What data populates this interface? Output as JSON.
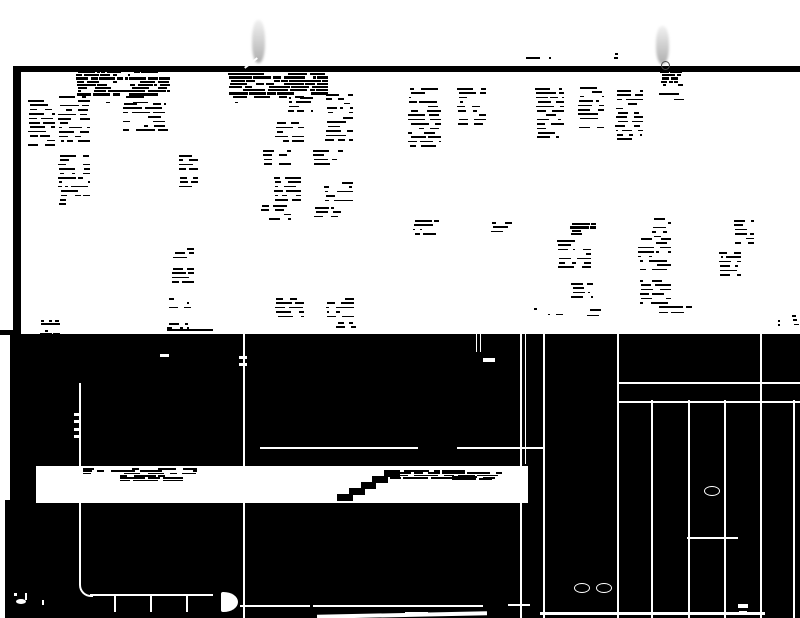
{
  "document": {
    "type": "degraded-binary-scan",
    "legible_text": ""
  },
  "colors": {
    "paper": "#ffffff",
    "ink": "#000000",
    "pin_gray": "#bfbfbf",
    "pin_ring": "#4a4a4a",
    "map_line": "#ffffff"
  },
  "paper": {
    "left_strip": [
      0,
      0,
      13,
      618
    ],
    "top_bar": [
      13,
      66,
      787,
      6
    ],
    "left_border": [
      13,
      66,
      8,
      269
    ],
    "page_edge_mark": [
      0,
      330,
      18,
      5
    ]
  },
  "pins": [
    {
      "body": [
        252,
        20,
        13,
        43
      ],
      "ring": null
    },
    {
      "body": [
        656,
        26,
        13,
        38
      ],
      "ring": [
        661,
        61,
        7,
        7
      ]
    }
  ],
  "text_blobs": [
    [
      76,
      71,
      94,
      25,
      "dense"
    ],
    [
      84,
      96,
      82,
      8,
      "sparse"
    ],
    [
      228,
      70,
      100,
      26,
      "dense"
    ],
    [
      232,
      96,
      72,
      7,
      "sparse"
    ],
    [
      28,
      100,
      27,
      45,
      "text"
    ],
    [
      58,
      96,
      32,
      46,
      "text"
    ],
    [
      123,
      103,
      45,
      29,
      "text"
    ],
    [
      58,
      155,
      32,
      50,
      "text"
    ],
    [
      178,
      155,
      20,
      33,
      "text"
    ],
    [
      287,
      97,
      26,
      17,
      "text"
    ],
    [
      325,
      94,
      28,
      22,
      "text"
    ],
    [
      275,
      118,
      29,
      26,
      "text"
    ],
    [
      325,
      117,
      28,
      27,
      "text"
    ],
    [
      263,
      150,
      28,
      18,
      "text"
    ],
    [
      313,
      150,
      30,
      18,
      "text"
    ],
    [
      273,
      177,
      28,
      24,
      "text"
    ],
    [
      323,
      182,
      30,
      19,
      "text"
    ],
    [
      260,
      205,
      31,
      16,
      "text"
    ],
    [
      313,
      207,
      28,
      14,
      "text"
    ],
    [
      275,
      298,
      29,
      19,
      "text"
    ],
    [
      325,
      298,
      29,
      19,
      "text"
    ],
    [
      408,
      88,
      33,
      61,
      "text"
    ],
    [
      457,
      88,
      29,
      38,
      "text"
    ],
    [
      535,
      88,
      29,
      50,
      "text"
    ],
    [
      578,
      87,
      26,
      41,
      "text"
    ],
    [
      615,
      90,
      28,
      53,
      "text"
    ],
    [
      658,
      93,
      26,
      10,
      "sparse"
    ],
    [
      660,
      71,
      23,
      17,
      "dense"
    ],
    [
      570,
      220,
      26,
      14,
      "dense"
    ],
    [
      557,
      240,
      34,
      31,
      "text"
    ],
    [
      570,
      283,
      23,
      18,
      "text"
    ],
    [
      652,
      218,
      19,
      20,
      "text"
    ],
    [
      638,
      238,
      33,
      36,
      "text"
    ],
    [
      638,
      280,
      33,
      28,
      "text"
    ],
    [
      733,
      220,
      21,
      24,
      "text"
    ],
    [
      718,
      252,
      23,
      24,
      "text"
    ],
    [
      413,
      220,
      26,
      18,
      "text"
    ],
    [
      490,
      222,
      22,
      14,
      "text"
    ],
    [
      172,
      248,
      22,
      10,
      "text"
    ],
    [
      170,
      268,
      24,
      18,
      "text"
    ],
    [
      168,
      298,
      23,
      10,
      "text"
    ],
    [
      167,
      323,
      22,
      8,
      "text"
    ],
    [
      167,
      329,
      46,
      2,
      "solid"
    ],
    [
      533,
      308,
      30,
      9,
      "sparse"
    ],
    [
      573,
      309,
      28,
      8,
      "sparse"
    ],
    [
      640,
      306,
      52,
      11,
      "sparse"
    ],
    [
      335,
      322,
      26,
      9,
      "text"
    ],
    [
      40,
      320,
      20,
      15,
      "dense"
    ],
    [
      775,
      320,
      10,
      8,
      "text"
    ],
    [
      525,
      57,
      26,
      6,
      "sparse"
    ],
    [
      612,
      53,
      6,
      9,
      "text"
    ],
    [
      792,
      315,
      8,
      14,
      "text"
    ]
  ],
  "map": {
    "region": [
      10,
      334,
      790,
      284
    ],
    "strip_taper": [
      5,
      500,
      5,
      118
    ],
    "lines": [
      [
        79,
        383,
        2,
        201
      ],
      [
        243,
        334,
        2,
        284
      ],
      [
        520,
        334,
        2,
        284
      ],
      [
        525,
        334,
        1,
        130
      ],
      [
        543,
        334,
        2,
        284
      ],
      [
        617,
        334,
        2,
        284
      ],
      [
        651,
        400,
        2,
        218
      ],
      [
        688,
        400,
        2,
        218
      ],
      [
        724,
        400,
        2,
        218
      ],
      [
        760,
        334,
        2,
        284
      ],
      [
        793,
        400,
        2,
        218
      ],
      [
        476,
        334,
        1,
        18
      ],
      [
        480,
        334,
        1,
        18
      ],
      [
        617,
        382,
        183,
        2
      ],
      [
        617,
        401,
        183,
        2
      ],
      [
        260,
        447,
        158,
        2
      ],
      [
        457,
        447,
        86,
        2
      ],
      [
        687,
        537,
        51,
        2
      ],
      [
        90,
        594,
        123,
        2
      ],
      [
        114,
        594,
        2,
        18
      ],
      [
        150,
        594,
        2,
        18
      ],
      [
        186,
        594,
        2,
        18
      ],
      [
        240,
        605,
        70,
        2
      ],
      [
        313,
        605,
        170,
        2
      ],
      [
        405,
        612,
        23,
        2
      ],
      [
        508,
        604,
        22,
        2
      ]
    ],
    "arc": [
      79,
      583,
      12,
      12
    ],
    "disc": [
      221,
      592,
      17,
      20
    ],
    "wedges": [
      [
        317,
        613,
        170,
        4,
        -1.2
      ],
      [
        540,
        612,
        225,
        3,
        0
      ]
    ],
    "ellipses": [
      [
        704,
        486,
        14,
        8
      ],
      [
        574,
        583,
        14,
        8
      ],
      [
        596,
        583,
        14,
        8
      ]
    ],
    "specks": [
      [
        483,
        358,
        12,
        4
      ],
      [
        160,
        354,
        9,
        3
      ],
      [
        74,
        413,
        5,
        3
      ],
      [
        74,
        420,
        5,
        3
      ],
      [
        74,
        428,
        5,
        3
      ],
      [
        74,
        435,
        5,
        3
      ],
      [
        239,
        356,
        8,
        3
      ],
      [
        239,
        363,
        8,
        3
      ],
      [
        738,
        604,
        10,
        4
      ],
      [
        739,
        611,
        8,
        3
      ],
      [
        42,
        600,
        2,
        5
      ]
    ],
    "glyph": {
      "ellipse": [
        16,
        599,
        10,
        5
      ],
      "stem": [
        25,
        593,
        2,
        7
      ],
      "dot": [
        14,
        593,
        3,
        3
      ]
    },
    "band": {
      "rect": [
        36,
        466,
        492,
        37
      ],
      "streaks": [
        [
          83,
          468,
          114,
          7
        ],
        [
          120,
          475,
          63,
          5
        ],
        [
          390,
          470,
          113,
          8
        ],
        [
          452,
          476,
          40,
          4
        ]
      ],
      "stairs": [
        337,
        470,
        59,
        30
      ]
    }
  }
}
